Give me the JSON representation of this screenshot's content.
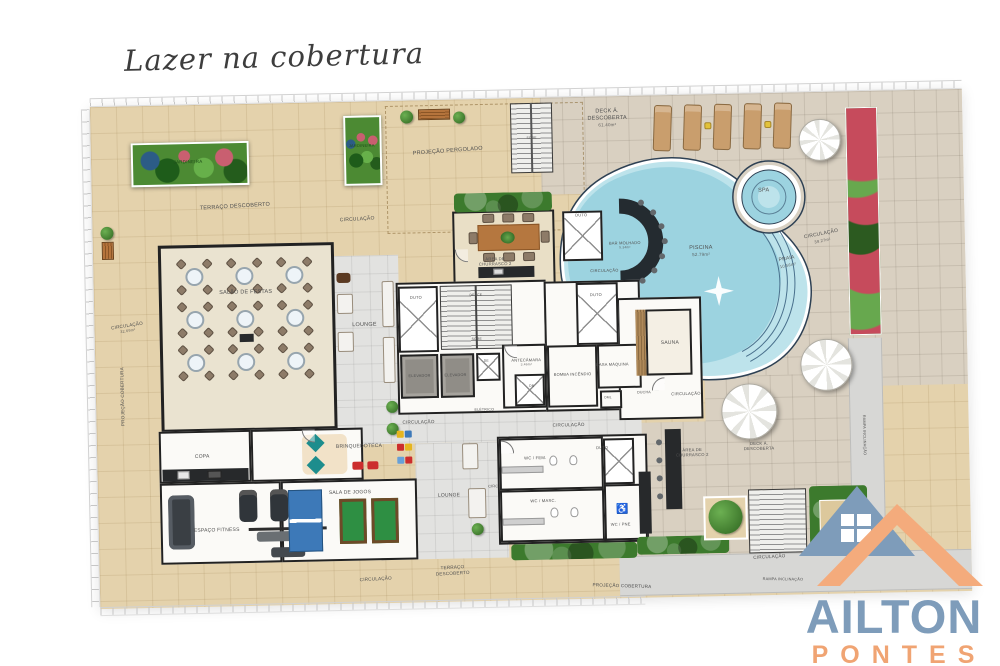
{
  "title": "Lazer na cobertura",
  "logo": {
    "name": "AILTON",
    "surname": "PONTES"
  },
  "colors": {
    "accent_blue": "#7e9cba",
    "accent_orange": "#f0a473",
    "pool": "#9cd3e0",
    "terrace": "#e4d2ac",
    "stone": "#d9d0c1",
    "hedge": "#3c7a2d",
    "wall": "#222222"
  },
  "labels": [
    {
      "id": "jardineira-1",
      "t": "JARDINEIRA",
      "x": 97,
      "y": 57,
      "s": 4.5,
      "c": "#1e4d18"
    },
    {
      "id": "terraco-descoberto-top",
      "t": "TERRAÇO DESCOBERTO",
      "x": 143,
      "y": 103,
      "s": 5.5,
      "r": -2
    },
    {
      "id": "circulacao-top",
      "t": "CIRCULAÇÃO",
      "x": 265,
      "y": 118,
      "s": 5,
      "r": -2
    },
    {
      "id": "projecao-pergolado",
      "t": "PROJEÇÃO PERGOLADO",
      "x": 357,
      "y": 52,
      "s": 5.5,
      "r": -3
    },
    {
      "id": "jardineira-2",
      "t": "JARDINEIRA",
      "x": 271,
      "y": 44,
      "s": 4,
      "c": "#1e4d18"
    },
    {
      "id": "deck-descoberta-1",
      "t": "DECK Á. DESCOBERTA",
      "sub": "61.40m²",
      "x": 517,
      "y": 22,
      "s": 5.5,
      "w": 54
    },
    {
      "id": "spa",
      "t": "SPA",
      "x": 672,
      "y": 98,
      "s": 5.5
    },
    {
      "id": "piscina",
      "t": "PISCINA",
      "sub": "52.79m²",
      "x": 608,
      "y": 157,
      "s": 5.5
    },
    {
      "id": "praia",
      "t": "PRAIA",
      "sub": "10.56m²",
      "x": 694,
      "y": 169,
      "s": 5,
      "r": -10
    },
    {
      "id": "circulacao-direita",
      "t": "CIRCULAÇÃO",
      "sub": "39.27m²",
      "x": 729,
      "y": 145,
      "s": 5,
      "r": -10
    },
    {
      "id": "bar-molhado",
      "t": "BAR MOLHADO",
      "sub": "5.34m²",
      "x": 532,
      "y": 149,
      "s": 4,
      "w": 34
    },
    {
      "id": "duto-bar",
      "t": "DUTO",
      "x": 489,
      "y": 118,
      "s": 4
    },
    {
      "id": "circulacao-bar",
      "t": "CIRCULAÇÃO",
      "x": 511,
      "y": 174,
      "s": 4
    },
    {
      "id": "area-churrasco-1",
      "t": "ÁREA DE CHURRASCO 2",
      "x": 402,
      "y": 163,
      "s": 4.2,
      "w": 48
    },
    {
      "id": "salao-de-festas",
      "t": "SALÃO DE FESTAS",
      "x": 152,
      "y": 189,
      "s": 5.5
    },
    {
      "id": "lounge-1",
      "t": "LOUNGE",
      "x": 270,
      "y": 224,
      "s": 5.5
    },
    {
      "id": "duto-core",
      "t": "DUTO",
      "x": 322,
      "y": 197,
      "s": 4
    },
    {
      "id": "duto-direita",
      "t": "DUTO",
      "x": 502,
      "y": 198,
      "s": 4
    },
    {
      "id": "elevador-1",
      "t": "ELEVADOR",
      "x": 324,
      "y": 276,
      "s": 3.8
    },
    {
      "id": "elevador-2",
      "t": "ELEVADOR",
      "x": 360,
      "y": 276,
      "s": 3.8
    },
    {
      "id": "antecamara",
      "t": "ANTECÂMARA",
      "sub": "3.46m²",
      "x": 431,
      "y": 264,
      "s": 4
    },
    {
      "id": "bomba-incendio",
      "t": "BOMBA INCÊNDIO",
      "x": 477,
      "y": 277,
      "s": 4,
      "w": 38
    },
    {
      "id": "casa-maquina",
      "t": "CASA MÁQUINA",
      "x": 517,
      "y": 268,
      "s": 4,
      "w": 34
    },
    {
      "id": "sauna",
      "t": "SAUNA",
      "x": 575,
      "y": 248,
      "s": 5
    },
    {
      "id": "ducha",
      "t": "DUCHA",
      "x": 548,
      "y": 297,
      "s": 3.6
    },
    {
      "id": "circulacao-sauna",
      "t": "CIRCULAÇÃO",
      "x": 590,
      "y": 299,
      "s": 4.2
    },
    {
      "id": "circulacao-core",
      "t": "CIRCULAÇÃO",
      "x": 322,
      "y": 322,
      "s": 4.6
    },
    {
      "id": "eletrico",
      "t": "ELÉTRICO",
      "x": 388,
      "y": 311,
      "s": 3.6
    },
    {
      "id": "circulacao-wc",
      "t": "CIRCULAÇÃO",
      "x": 472,
      "y": 328,
      "s": 4.6
    },
    {
      "id": "copa",
      "t": "COPA",
      "x": 105,
      "y": 352,
      "s": 5
    },
    {
      "id": "brinquedoteca",
      "t": "BRINQUEDOTECA",
      "x": 262,
      "y": 345,
      "s": 5
    },
    {
      "id": "espaco-fitness",
      "t": "ESPAÇO FITNESS",
      "x": 118,
      "y": 426,
      "s": 5
    },
    {
      "id": "sala-de-jogos",
      "t": "SALA DE JOGOS",
      "x": 252,
      "y": 391,
      "s": 5
    },
    {
      "id": "lounge-2",
      "t": "LOUNGE",
      "x": 351,
      "y": 396,
      "s": 5
    },
    {
      "id": "circ",
      "t": "CIRC.",
      "x": 396,
      "y": 388,
      "s": 3.8
    },
    {
      "id": "wc-fem",
      "t": "WC / FEM.",
      "x": 438,
      "y": 360,
      "s": 4.2
    },
    {
      "id": "wc-masc",
      "t": "WC / MASC.",
      "x": 445,
      "y": 403,
      "s": 4.2
    },
    {
      "id": "duto-wc",
      "t": "DUTO",
      "x": 505,
      "y": 351,
      "s": 4
    },
    {
      "id": "wc-pne",
      "t": "WC / PNE",
      "x": 522,
      "y": 428,
      "s": 4
    },
    {
      "id": "area-churrasco-2",
      "t": "ÁREA DE CHURRASCO 2",
      "x": 595,
      "y": 358,
      "s": 4.2,
      "w": 44
    },
    {
      "id": "deck-descoberta-2",
      "t": "DECK Á. DESCOBERTA",
      "x": 662,
      "y": 353,
      "s": 4.2,
      "w": 46
    },
    {
      "id": "circulacao-inferior-direita",
      "t": "CIRCULAÇÃO",
      "x": 670,
      "y": 464,
      "s": 4.6,
      "r": -2
    },
    {
      "id": "rampa-direita",
      "t": "RAMPA INCLINAÇÃO",
      "x": 767,
      "y": 344,
      "s": 3.8,
      "r": 90
    },
    {
      "id": "projecao-cobertura-esquerda",
      "t": "PROJEÇÃO COBERTURA",
      "x": 27,
      "y": 290,
      "s": 4.6,
      "r": -90
    },
    {
      "id": "circulacao-esquerda",
      "t": "CIRCULAÇÃO",
      "sub": "32.69m²",
      "x": 33,
      "y": 222,
      "s": 4.6,
      "r": -8
    },
    {
      "id": "terraco-descoberto-inferior",
      "t": "TERRAÇO DESCOBERTO",
      "x": 353,
      "y": 471,
      "s": 4.6,
      "r": -2,
      "w": 50
    },
    {
      "id": "circulacao-inferior-esquerda",
      "t": "CIRCULAÇÃO",
      "x": 276,
      "y": 478,
      "s": 4.6,
      "r": -2
    },
    {
      "id": "projecao-cobertura-inferior",
      "t": "PROJEÇÃO COBERTURA",
      "x": 522,
      "y": 490,
      "s": 4.6,
      "r": 3
    },
    {
      "id": "rampa-inferior",
      "t": "RAMPA INCLINAÇÃO",
      "x": 683,
      "y": 487,
      "s": 3.8,
      "r": 2
    },
    {
      "id": "desce-escada",
      "t": "DESCE",
      "x": 382,
      "y": 196,
      "s": 3.4
    },
    {
      "id": "sobe-escada",
      "t": "SOBE",
      "x": 382,
      "y": 240,
      "s": 3.4
    },
    {
      "id": "sobe-escada-externa",
      "t": "SOBE",
      "x": 441,
      "y": 40,
      "s": 3.4
    },
    {
      "id": "de",
      "t": "DE",
      "x": 391,
      "y": 262,
      "s": 3.4
    },
    {
      "id": "dn",
      "t": "DN",
      "x": 436,
      "y": 288,
      "s": 3.4
    },
    {
      "id": "dml",
      "t": "DML",
      "x": 512,
      "y": 301,
      "s": 3.2
    }
  ]
}
